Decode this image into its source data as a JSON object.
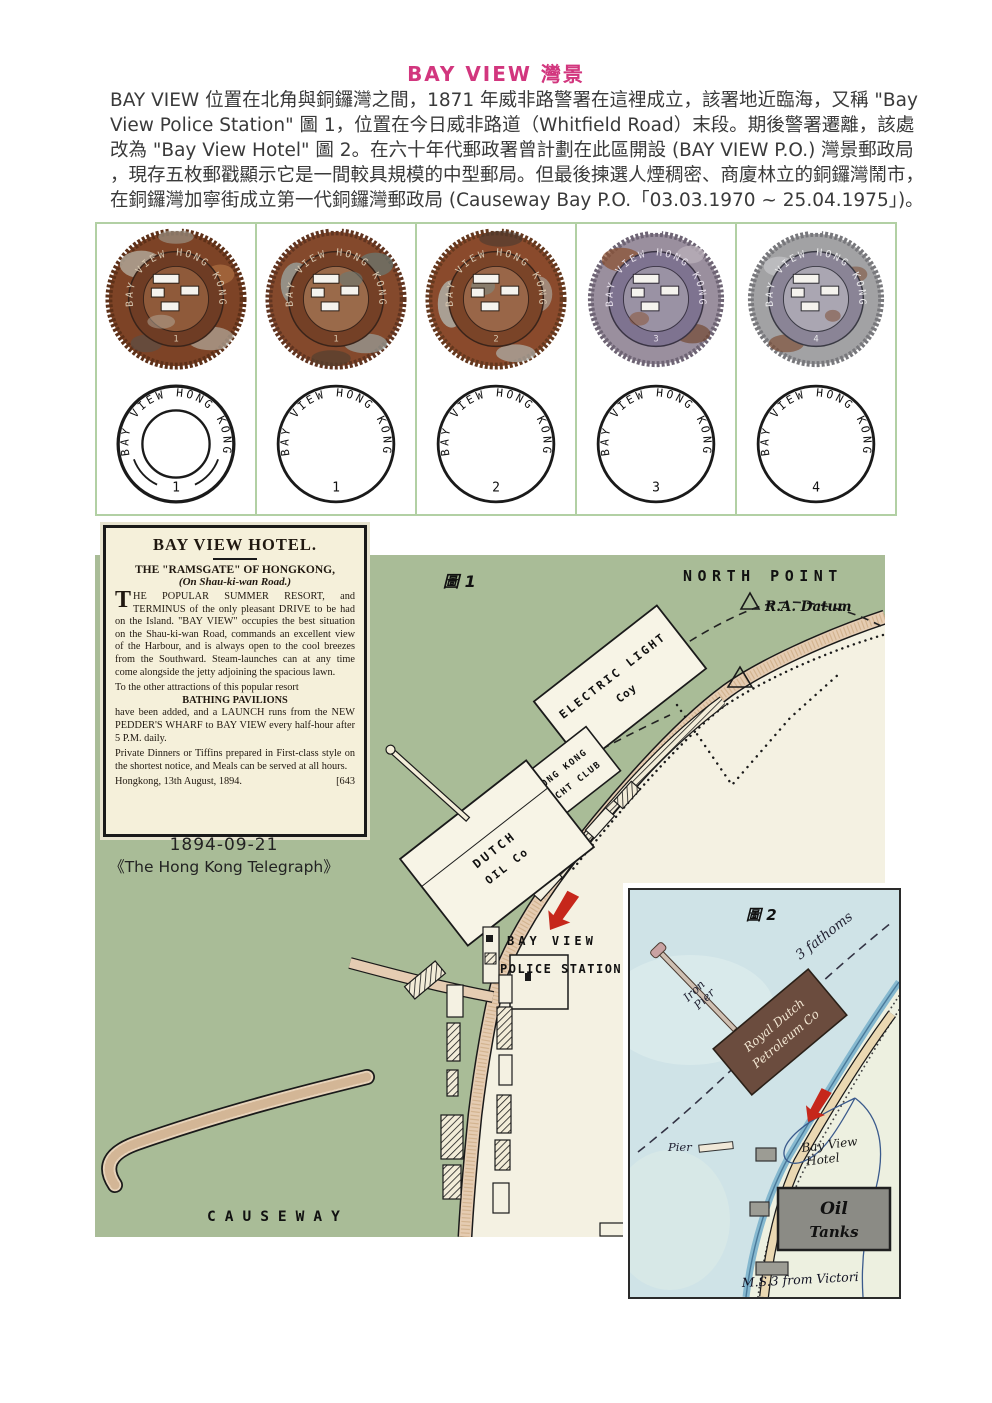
{
  "page": {
    "title": "BAY VIEW 灣景",
    "intro_lines": [
      "BAY VIEW 位置在北角與銅鑼灣之間，1871 年威非路警署在這裡成立，該署地近臨海，又稱 \"Bay",
      "View Police Station\" 圖 1，位置在今日威非路道（Whitfield Road）末段。期後警署遷離，該處",
      "改為 \"Bay View Hotel\" 圖 2。在六十年代郵政署曾計劃在此區開設 (BAY VIEW P.O.) 灣景郵政局",
      "，現存五枚郵戳顯示它是一間較具規模的中型郵局。但最後揀選人煙稠密、商廈林立的銅鑼灣鬧市，",
      "在銅鑼灣加寧街成立第一代銅鑼灣郵政局 (Causeway Bay P.O.「03.03.1970 ~ 25.04.1975」)。"
    ]
  },
  "chops": {
    "ring_text": "BAY VIEW HONG KONG",
    "items": [
      {
        "number": "1"
      },
      {
        "number": "1"
      },
      {
        "number": "2"
      },
      {
        "number": "3"
      },
      {
        "number": "4"
      }
    ]
  },
  "clipping": {
    "title": "BAY VIEW HOTEL.",
    "sub1": "THE \"RAMSGATE\" OF HONGKONG,",
    "sub2": "(On Shau-ki-wan Road.)",
    "para1": "THE POPULAR SUMMER RESORT, and TERMINUS of the only pleasant DRIVE to be had on the Island. \"BAY VIEW\" occupies the best situation on the Shau-ki-wan Road, commands an excellent view of the Harbour, and is always open to the cool breezes from the Southward. Steam-launches can at any time come alongside the jetty adjoining the spacious lawn.",
    "para2a": "To the other attractions of this popular resort",
    "para2b": "BATHING PAVILIONS",
    "para2c": "have been added, and a LAUNCH runs from the NEW PEDDER'S WHARF to BAY VIEW every half-hour after 5 P.M. daily.",
    "para3": "Private Dinners or Tiffins prepared in First-class style on the shortest notice, and Meals can be served at all hours.",
    "dateline": "Hongkong, 13th August, 1894.",
    "ref": "[643",
    "caption_date": "1894-09-21",
    "caption_source": "《The Hong Kong Telegraph》"
  },
  "map1": {
    "figure": "圖 1",
    "north_point": "NORTH POINT",
    "ra_datum": "R.A. Datum",
    "electric": [
      "ELECTRIC LIGHT",
      "Coy"
    ],
    "yacht": [
      "HONG KONG",
      "YACHT CLUB"
    ],
    "dutch": [
      "DUTCH",
      "OIL Co"
    ],
    "bay_view": "BAY VIEW",
    "police_station": "POLICE STATION",
    "causeway": "CAUSEWAY"
  },
  "map2": {
    "figure": "圖 2",
    "fathoms": "3 fathoms",
    "iron_pier": [
      "Iron",
      "Pier"
    ],
    "royal": [
      "Royal Dutch",
      "Petroleum Co"
    ],
    "pier": "Pier",
    "hotel": [
      "Bay View",
      "Hotel"
    ],
    "oil": [
      "Oil",
      "Tanks"
    ],
    "ms3": "M.S.3 from Victori"
  },
  "colors": {
    "accent_pink": "#d2367e",
    "grid_green": "#b2d0a4",
    "map_green": "#a9bc97",
    "water_ivory": "#f4f1e2",
    "inset_water": "#cfe3e7",
    "arrow_red": "#c6271b"
  }
}
